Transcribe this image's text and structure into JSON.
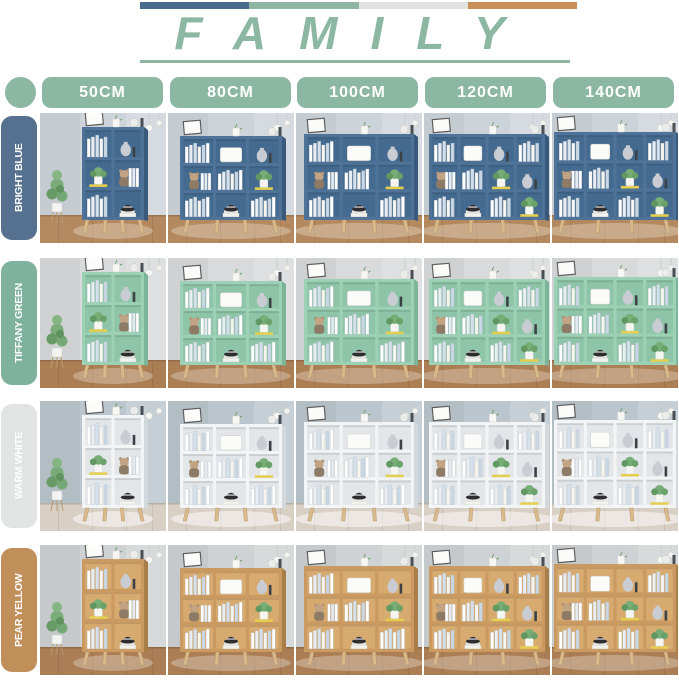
{
  "header": {
    "title": "FAMILY",
    "bar_colors": [
      "#4a6a8c",
      "#8fb6a2",
      "#e1e3e2",
      "#c98f57"
    ],
    "accent": "#8cb7a3",
    "underline_color": "#8fb5a1"
  },
  "size_labels": [
    "50CM",
    "80CM",
    "100CM",
    "120CM",
    "140CM"
  ],
  "color_rows": [
    {
      "id": "bright-blue",
      "name": "BRIGHT BLUE",
      "label_bg": "#55718f",
      "label_text": "#ffffff",
      "shelf_front": "#4f7398",
      "shelf_side": "#3a5a7c",
      "shelf_inner": "#446a8f",
      "wall": "#ccd4da",
      "floor": "#b4895f"
    },
    {
      "id": "tiffany-green",
      "name": "TIFFANY GREEN",
      "label_bg": "#7fb29c",
      "label_text": "#ffffff",
      "shelf_front": "#9dd1b6",
      "shelf_side": "#7cb598",
      "shelf_inner": "#8ec4a8",
      "wall": "#d8dadb",
      "floor": "#ac7e54"
    },
    {
      "id": "warm-white",
      "name": "WARM WHITE",
      "label_bg": "#e1e4e3",
      "label_text": "#ffffff",
      "shelf_front": "#f2f4f5",
      "shelf_side": "#d2d8dc",
      "shelf_inner": "#e2e6e9",
      "wall": "#bac5cd",
      "floor": "#d8cfc5"
    },
    {
      "id": "pear-yellow",
      "name": "PEAR YELLOW",
      "label_bg": "#c08f5a",
      "label_text": "#ffffff",
      "shelf_front": "#ca9a61",
      "shelf_side": "#a97f49",
      "shelf_inner": "#d7aa70",
      "wall": "#cfd2d4",
      "floor": "#ab7e55"
    }
  ],
  "variants": [
    {
      "size": "50CM",
      "cols": 2,
      "shelf_w": 62,
      "shelf_h": 93,
      "shift_x": 10,
      "has_plant": true
    },
    {
      "size": "80CM",
      "cols": 3,
      "shelf_w": 102,
      "shelf_h": 84,
      "shift_x": 0,
      "has_plant": false
    },
    {
      "size": "100CM",
      "cols": 3,
      "shelf_w": 110,
      "shelf_h": 86,
      "shift_x": 0,
      "has_plant": false
    },
    {
      "size": "120CM",
      "cols": 4,
      "shelf_w": 116,
      "shelf_h": 86,
      "shift_x": 0,
      "has_plant": false
    },
    {
      "size": "140CM",
      "cols": 4,
      "shelf_w": 122,
      "shelf_h": 88,
      "shift_x": 0,
      "has_plant": false
    }
  ],
  "cell_layouts": {
    "2": [
      [
        "books",
        "vase"
      ],
      [
        "plant",
        "teddy-doll"
      ],
      [
        "books",
        "hat"
      ]
    ],
    "3": [
      [
        "books",
        "storage-box",
        "vase"
      ],
      [
        "teddy-doll",
        "books",
        "plant"
      ],
      [
        "books",
        "hat",
        "books"
      ]
    ],
    "4": [
      [
        "books",
        "storage-box",
        "vase",
        "books"
      ],
      [
        "teddy-doll",
        "books",
        "plant",
        "vase"
      ],
      [
        "books",
        "hat",
        "books",
        "plant"
      ]
    ]
  },
  "decor_items": [
    "books",
    "storage-box",
    "vase",
    "plant",
    "teddy-doll",
    "hat",
    "picture-frame",
    "hanging-lights",
    "potted-plant"
  ],
  "leg_color": "#d9ba8c"
}
